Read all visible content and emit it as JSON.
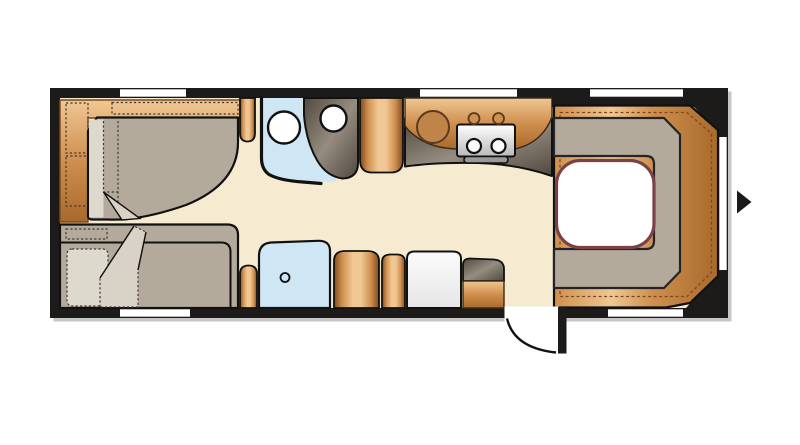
{
  "title": "Caravan floor plan",
  "colors": {
    "wall": "#1d1b19",
    "shadow": "#c6c6c6",
    "floor": "#f6ead0",
    "window": "#ffffff",
    "wood_light": "#f0c793",
    "wood_mid": "#cf8f4e",
    "wood_dark": "#a86a2c",
    "wood_edge": "#7c4a1e",
    "wood_deep": "#8a5526",
    "upholstery": "#b4aa9c",
    "upholstery_line": "#23232a",
    "pillow": "#ded9cd",
    "fold": "#d8d3c6",
    "blue": "#cfe6f5",
    "dark_unit_hi": "#968c80",
    "dark_unit_lo": "#50493f",
    "silver_hi": "#ffffff",
    "silver_lo": "#b9b9b9",
    "fridge_hi": "#fbfbfb",
    "fridge_lo": "#e6e6e6",
    "sink_fill": "#c08448",
    "sink_edge": "#5a3a22",
    "table_fill": "#ffffff",
    "table_edge": "#7b4144",
    "stitch": "#7a4a1e",
    "dash": "#3a3a3a",
    "outline": "#111111",
    "handle": "#999999"
  }
}
